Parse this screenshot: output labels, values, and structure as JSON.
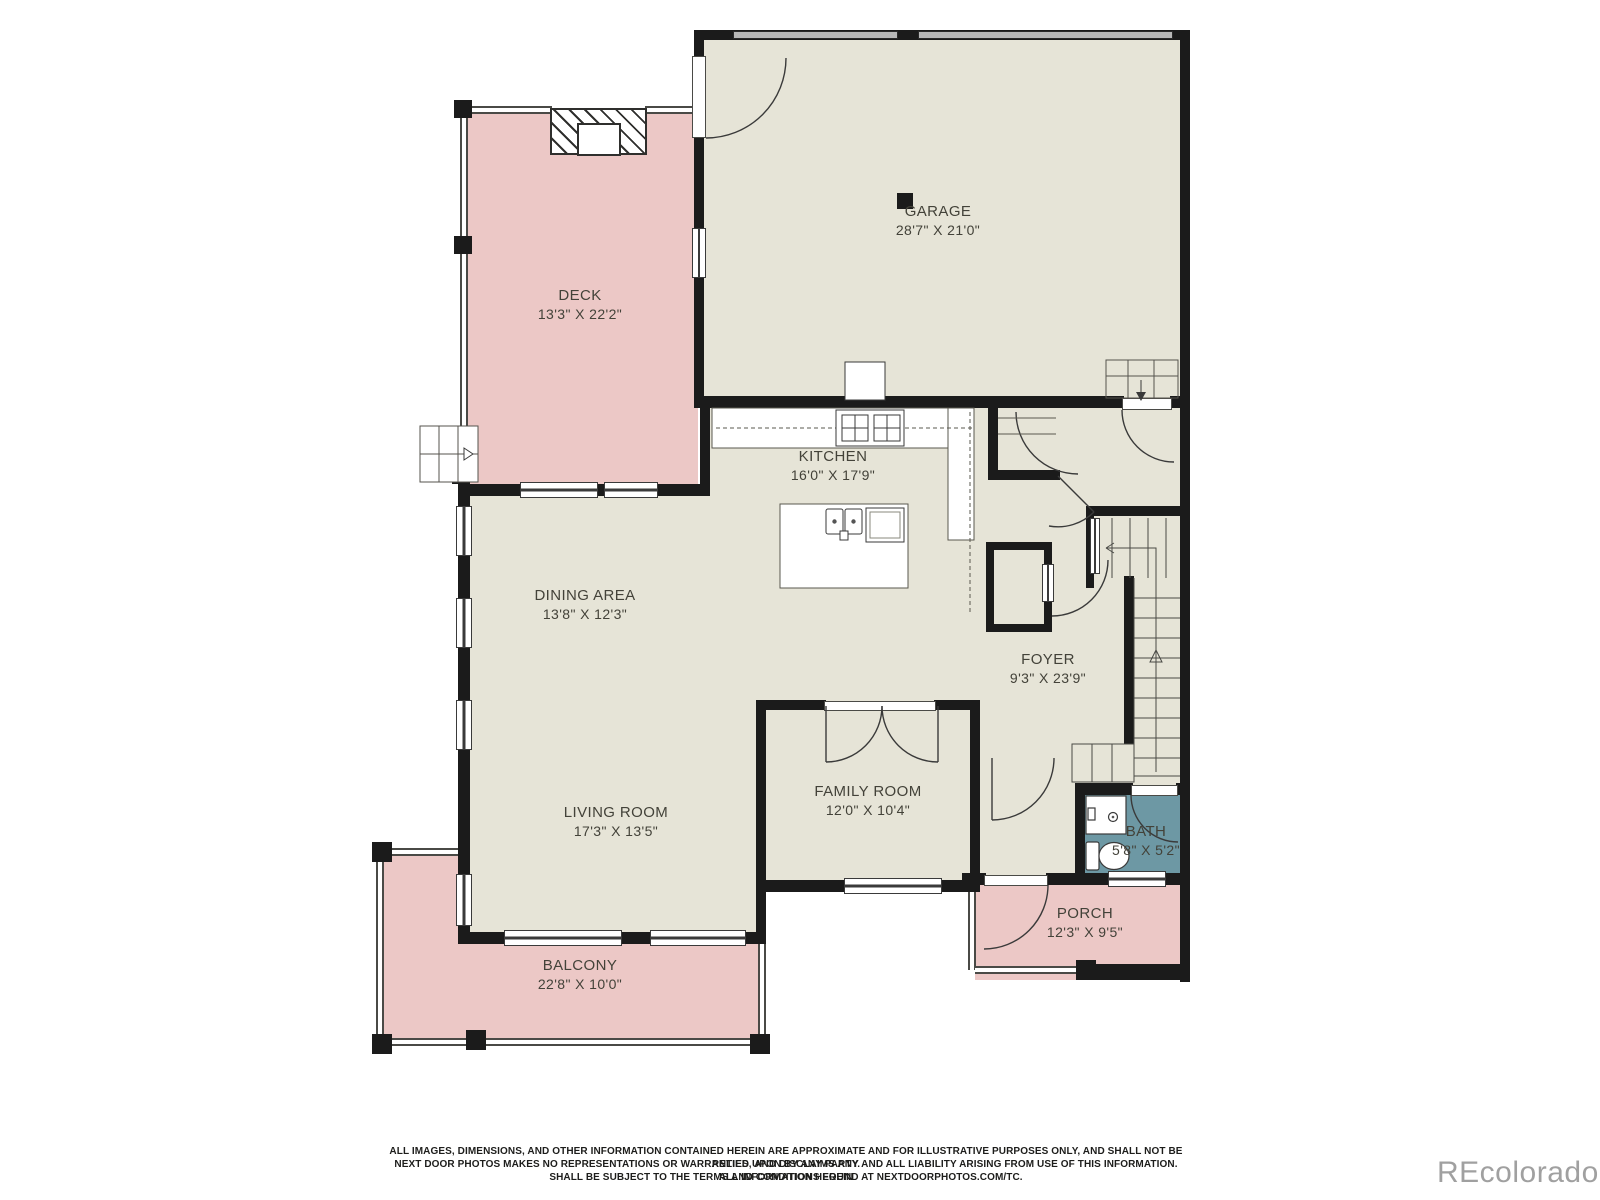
{
  "plan_title": "First floor plan",
  "colors": {
    "floor": "#e6e4d7",
    "outdoor": "#ecc8c6",
    "bath": "#6d98a4",
    "wall": "#1b1b1b",
    "linework": "#3a3a3a",
    "watermark": "#a0a0a0"
  },
  "rooms": {
    "garage": {
      "name": "GARAGE",
      "dims": "28'7\" X 21'0\""
    },
    "deck": {
      "name": "DECK",
      "dims": "13'3\" X 22'2\""
    },
    "kitchen": {
      "name": "KITCHEN",
      "dims": "16'0\" X 17'9\""
    },
    "dining": {
      "name": "DINING AREA",
      "dims": "13'8\" X 12'3\""
    },
    "foyer": {
      "name": "FOYER",
      "dims": "9'3\" X 23'9\""
    },
    "living": {
      "name": "LIVING ROOM",
      "dims": "17'3\" X 13'5\""
    },
    "family": {
      "name": "FAMILY ROOM",
      "dims": "12'0\" X 10'4\""
    },
    "bath": {
      "name": "BATH",
      "dims": "5'8\" X 5'2\""
    },
    "porch": {
      "name": "PORCH",
      "dims": "12'3\" X 9'5\""
    },
    "balcony": {
      "name": "BALCONY",
      "dims": "22'8\" X 10'0\""
    }
  },
  "footer": {
    "line1": "ALL IMAGES, DIMENSIONS, AND OTHER INFORMATION CONTAINED HEREIN ARE APPROXIMATE AND FOR ILLUSTRATIVE PURPOSES ONLY, AND SHALL NOT BE RELIED UPON BY ANY PARTY.",
    "line2": "NEXT DOOR PHOTOS MAKES NO REPRESENTATIONS OR WARRANTIES, AND DISCLAIMS ANY AND ALL LIABILITY ARISING FROM USE OF THIS INFORMATION. ALL INFORMATION HEREIN",
    "line3": "SHALL BE SUBJECT TO THE TERMS AND CONDITIONS FOUND AT NEXTDOORPHOTOS.COM/TC.",
    "watermark": "REcolorado"
  }
}
